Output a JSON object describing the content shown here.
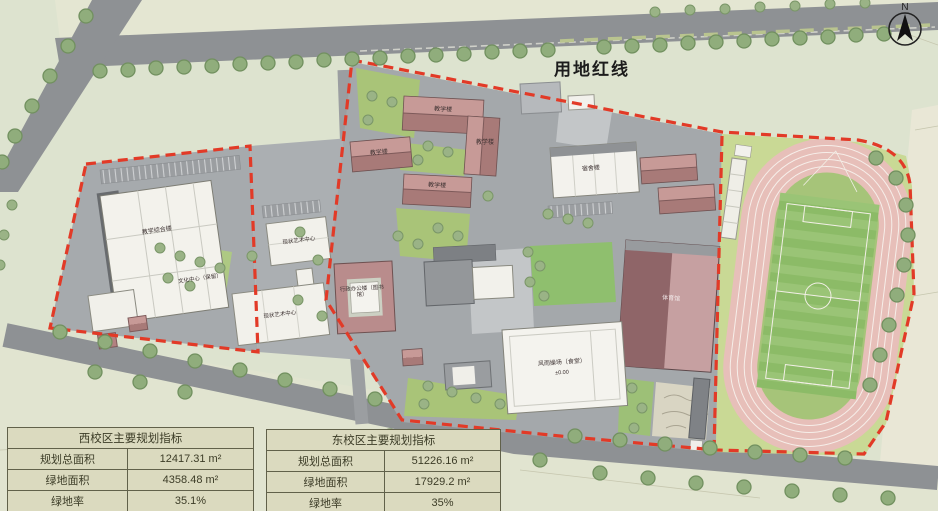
{
  "map": {
    "red_line_label": "用地红线",
    "north_label": "N",
    "buildings": {
      "west_main": "教学综合楼",
      "culture_center": "文化中心（保留）",
      "art_center_north": "现状艺术中心",
      "art_center_south": "现状艺术中心",
      "teaching_1": "教学楼",
      "teaching_2": "教学楼",
      "teaching_3": "教学楼",
      "teaching_4": "教学楼",
      "admin_library": "行政办公楼（图书馆）",
      "dormitory": "宿舍楼",
      "gymnasium": "体育馆",
      "canteen_hall": "风雨操场（食堂）",
      "canteen_elevation": "±0.00"
    },
    "colors": {
      "red_line": "#e23a27",
      "track": "#e7bfb9",
      "field_green": "#8cbb67",
      "roof_red": "#b98c8c",
      "road_gray": "#8e9194"
    }
  },
  "tables": {
    "west": {
      "title": "西校区主要规划指标",
      "rows": [
        {
          "label": "规划总面积",
          "value": "12417.31 m²"
        },
        {
          "label": "绿地面积",
          "value": "4358.48 m²"
        },
        {
          "label": "绿地率",
          "value": "35.1%"
        }
      ]
    },
    "east": {
      "title": "东校区主要规划指标",
      "rows": [
        {
          "label": "规划总面积",
          "value": "51226.16 m²"
        },
        {
          "label": "绿地面积",
          "value": "17929.2 m²"
        },
        {
          "label": "绿地率",
          "value": "35%"
        }
      ]
    }
  }
}
